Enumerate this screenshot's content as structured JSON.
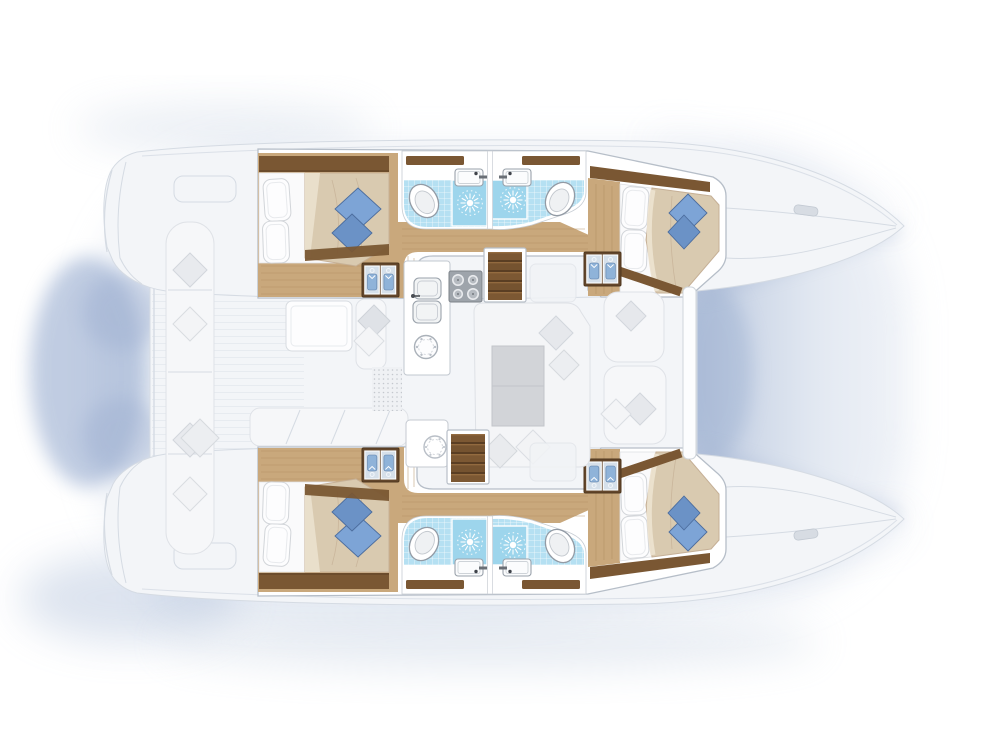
{
  "scene": {
    "title": "Catamaran yacht interior floor plan",
    "view": "top-down",
    "bow_direction": "right",
    "hulls": 2,
    "cabins": 4,
    "heads": 4,
    "render_style": "colour cutaway of hull interiors with ghosted exterior deck"
  },
  "palette": {
    "background": "#ffffff",
    "shadow_blue": "#93a7cc",
    "haze_blue": "#aebdd8",
    "ghost_fill": "#f3f5f8",
    "ghost_line": "#d5dbe3",
    "ghost_plank": "#e6eaef",
    "ghost_item": "#f6f7f9",
    "ghost_item_line": "#dfe2e7",
    "wall_white": "#ffffff",
    "wall_line": "#b6bec8",
    "wood": "#c9a87c",
    "wood_line": "#b08d60",
    "dark_wood": "#7a5733",
    "dark_wood_deep": "#5d4226",
    "tile_blue": "#b5e0f2",
    "shower_blue": "#9dd5ec",
    "linen": "#fafafb",
    "duvet": "#d9cab0",
    "duvet_light": "#e9dfcb",
    "cushion_blue": "#7da4d6",
    "cushion_blue_dark": "#4c6d9e",
    "shirt_blue": "#8fb3d9",
    "stove_gray": "#9ea4ab",
    "table_gray": "#d2d4d8"
  },
  "port_hull": {
    "position": "top",
    "rooms": [
      {
        "name": "aft-cabin",
        "furniture": [
          "double-bed",
          "two-white-pillows",
          "beige-duvet",
          "two-blue-cushions",
          "wardrobe-with-hanging-clothes",
          "dark-wood-shelf",
          "teak-floor"
        ]
      },
      {
        "name": "aft-head",
        "fixtures": [
          "toilet",
          "washbasin",
          "shower-drain",
          "blue-mosaic-floor"
        ]
      },
      {
        "name": "forward-head",
        "fixtures": [
          "toilet",
          "washbasin",
          "shower-drain",
          "blue-mosaic-floor"
        ]
      },
      {
        "name": "companionway",
        "features": [
          "teak-steps",
          "wood-corridor"
        ]
      },
      {
        "name": "forward-cabin",
        "furniture": [
          "double-bed",
          "two-white-pillows",
          "beige-duvet",
          "two-blue-cushions",
          "wardrobe-with-hanging-clothes",
          "teak-floor"
        ]
      }
    ]
  },
  "starboard_hull": {
    "position": "bottom",
    "mirror_of": "port_hull"
  },
  "bridge_deck": {
    "galley": {
      "fixtures": [
        "double-sink",
        "four-burner-stove",
        "round-hatch"
      ]
    },
    "saloon": {
      "furniture": [
        "u-shaped-sofa",
        "rectangular-table",
        "scatter-cushions",
        "forward-bench-seats"
      ]
    },
    "cockpit": {
      "furniture": [
        "long-side-bench",
        "aft-bench",
        "cockpit-table",
        "side-bench",
        "deck-mat"
      ],
      "deck": "plank-lines"
    },
    "stairways": [
      "port-companionway-steps",
      "starboard-companionway-steps"
    ]
  }
}
